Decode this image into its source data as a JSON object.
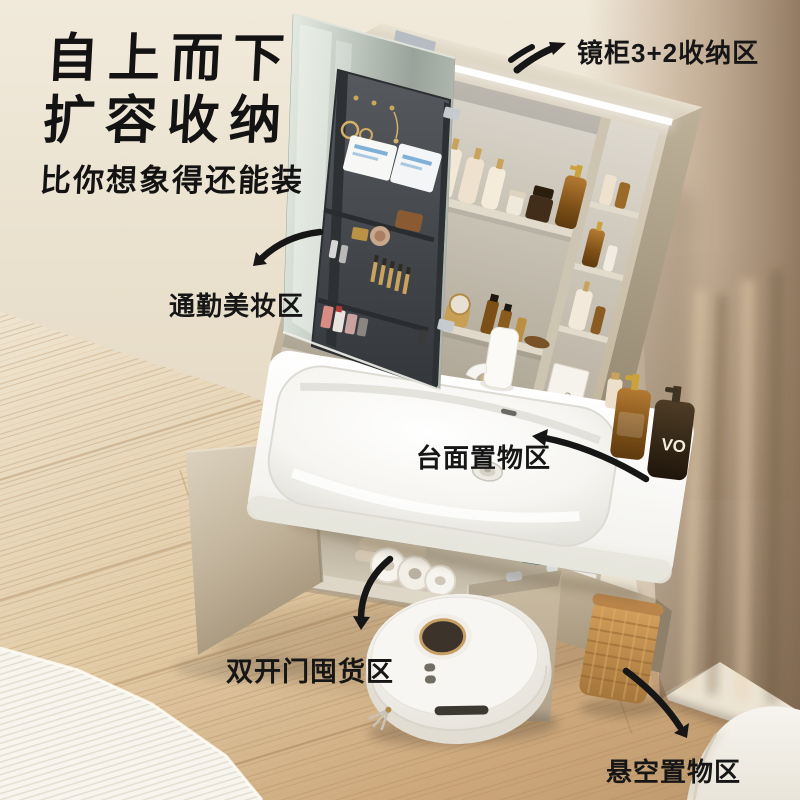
{
  "headline": {
    "line1": "自上而下",
    "line2": "扩容收纳",
    "subline": "比你想象得还能装"
  },
  "labels": {
    "mirror_cabinet": "镜柜3+2收纳区",
    "makeup_area": "通勤美妆区",
    "countertop": "台面置物区",
    "stock_area": "双开门囤货区",
    "floating_area": "悬空置物区"
  },
  "product_text": {
    "dark_bottle": "VO",
    "box": "oce"
  },
  "palette": {
    "ink_black": "#161616",
    "wall_cream": "#ece4d4",
    "curtain_taupe": "#a8927a",
    "floor_wood": "#d8bd95",
    "cabinet_greige": "#c9bca6",
    "organizer_gray": "#43474b",
    "amber_glass": "#8a5a22",
    "teal_jar": "#2e6a68",
    "basket_rattan": "#c08945",
    "led_white": "#ffffff",
    "robot_white": "#f4f2ee"
  }
}
